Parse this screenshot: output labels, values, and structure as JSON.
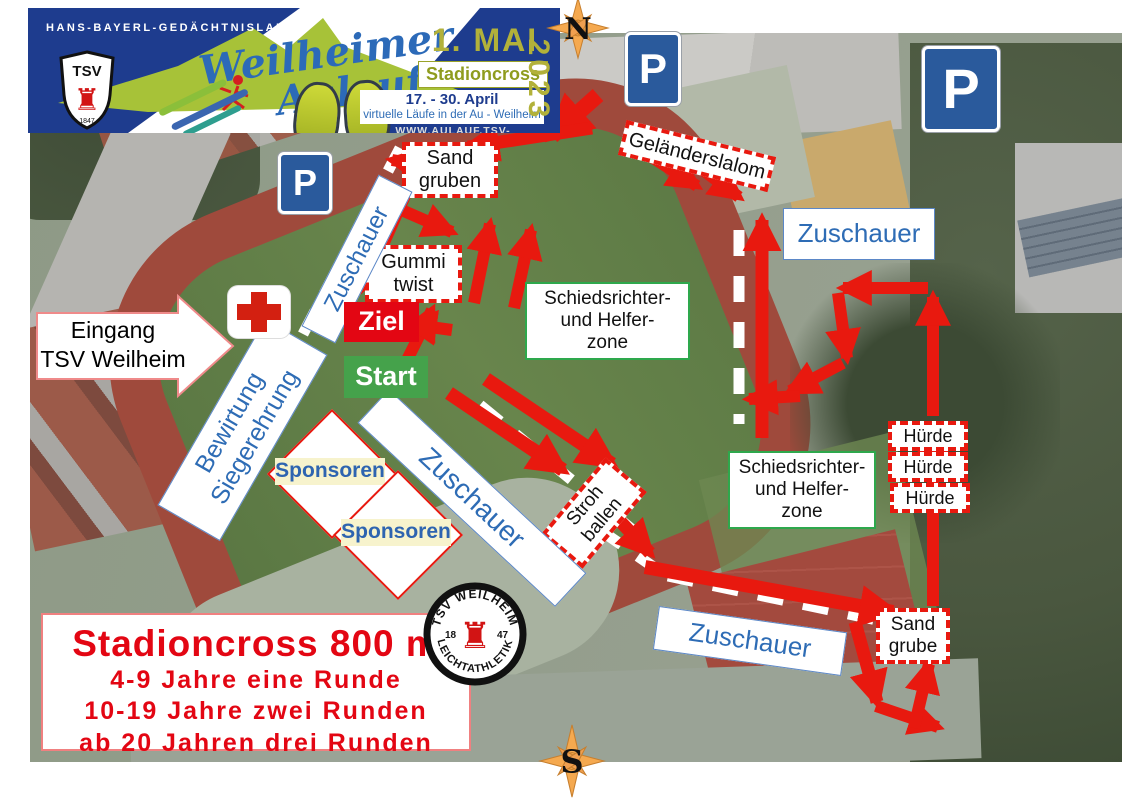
{
  "banner": {
    "kicker": "HANS-BAYERL-GEDÄCHTNISLAUF",
    "title_line1": "Weilheimer",
    "title_line2": "Aulauf",
    "date_main": "1. MAI",
    "event_name": "Stadioncross",
    "year": "2023",
    "date_range": "17. - 30. April",
    "date_sub": "virtuelle Läufe in der Au - Weilheim",
    "website": "WWW.AULAUF.TSV-WEILHEIM.COM",
    "shield_text": "TSV",
    "shield_year": "1847"
  },
  "compass": {
    "north": "N",
    "south": "S"
  },
  "entrance": {
    "line1": "Eingang",
    "line2": "TSV Weilheim"
  },
  "infobox": {
    "title": "Stadioncross 800 m",
    "rules": [
      "4-9 Jahre eine Runde",
      "10-19 Jahre zwei Runden",
      "ab 20 Jahren drei Runden"
    ]
  },
  "badge": {
    "arc_top": "TSV WEILHEIM",
    "arc_bottom": "LEICHTATHLETIK",
    "left": "18",
    "right": "47"
  },
  "colors": {
    "arrow_red": "#e8190f",
    "ziel_red": "#e30613",
    "start_green": "#45a24b",
    "label_blue": "#2e6cb5",
    "zone_green": "#2ea84c",
    "banner_navy": "#1e3c8e",
    "olive": "#b2b13a",
    "parking_blue": "#2a5a9c"
  },
  "map_labels": [
    {
      "id": "parking-sign-north-left",
      "type": "parking",
      "lines": [
        "P"
      ],
      "x": 625,
      "y": 32,
      "w": 56,
      "h": 74,
      "fs": 42
    },
    {
      "id": "parking-sign-north-right",
      "type": "parking",
      "lines": [
        "P"
      ],
      "x": 922,
      "y": 46,
      "w": 78,
      "h": 86,
      "fs": 56
    },
    {
      "id": "parking-sign-west",
      "type": "parking",
      "lines": [
        "P"
      ],
      "x": 278,
      "y": 152,
      "w": 54,
      "h": 62,
      "fs": 36
    },
    {
      "id": "label-gelaenderslalom",
      "type": "obstacle",
      "lines": [
        "Geländerslalom"
      ],
      "x": 620,
      "y": 138,
      "w": 154,
      "h": 36,
      "rot": 14,
      "fs": 20
    },
    {
      "id": "label-sandgruben",
      "type": "obstacle",
      "lines": [
        "Sand",
        "gruben"
      ],
      "x": 402,
      "y": 142,
      "w": 96,
      "h": 56,
      "rot": 0,
      "fs": 20
    },
    {
      "id": "label-gummitwist",
      "type": "obstacle",
      "lines": [
        "Gummi",
        "twist"
      ],
      "x": 365,
      "y": 245,
      "w": 97,
      "h": 58,
      "rot": 0,
      "fs": 20
    },
    {
      "id": "label-strohballen",
      "type": "obstacle",
      "lines": [
        "Stroh",
        "ballen"
      ],
      "x": 544,
      "y": 486,
      "w": 100,
      "h": 54,
      "rot": -50,
      "fs": 19
    },
    {
      "id": "label-huerde-1",
      "type": "obstacle",
      "lines": [
        "Hürde"
      ],
      "x": 888,
      "y": 421,
      "w": 80,
      "h": 30,
      "rot": 0,
      "fs": 18
    },
    {
      "id": "label-huerde-2",
      "type": "obstacle",
      "lines": [
        "Hürde"
      ],
      "x": 888,
      "y": 452,
      "w": 80,
      "h": 30,
      "rot": 0,
      "fs": 18
    },
    {
      "id": "label-huerde-3",
      "type": "obstacle",
      "lines": [
        "Hürde"
      ],
      "x": 890,
      "y": 483,
      "w": 80,
      "h": 30,
      "rot": 0,
      "fs": 18
    },
    {
      "id": "label-sandgrube",
      "type": "obstacle",
      "lines": [
        "Sand",
        "grube"
      ],
      "x": 876,
      "y": 608,
      "w": 74,
      "h": 56,
      "rot": 0,
      "fs": 19
    },
    {
      "id": "label-zuschauer-west",
      "type": "spectator",
      "lines": [
        "Zuschauer"
      ],
      "x": 272,
      "y": 240,
      "w": 170,
      "h": 38,
      "rot": -63,
      "fs": 24
    },
    {
      "id": "label-zuschauer-east",
      "type": "spectator",
      "lines": [
        "Zuschauer"
      ],
      "x": 783,
      "y": 208,
      "w": 152,
      "h": 52,
      "rot": 0,
      "fs": 26
    },
    {
      "id": "label-zuschauer-center",
      "type": "spectator",
      "lines": [
        "Zuschauer"
      ],
      "x": 337,
      "y": 475,
      "w": 270,
      "h": 46,
      "rot": 43,
      "fs": 28
    },
    {
      "id": "label-zuschauer-south",
      "type": "spectator",
      "lines": [
        "Zuschauer"
      ],
      "x": 655,
      "y": 619,
      "w": 190,
      "h": 44,
      "rot": 8,
      "fs": 26
    },
    {
      "id": "label-bewirtung-siegerehrung",
      "type": "spectator",
      "lines": [
        "Bewirtung",
        "Siegerehrung"
      ],
      "x": 135,
      "y": 394,
      "w": 215,
      "h": 72,
      "rot": -60,
      "fs": 25
    },
    {
      "id": "label-schiedsrichterzone-1",
      "type": "zone",
      "lines": [
        "Schiedsrichter-",
        "und Helfer-",
        "zone"
      ],
      "x": 525,
      "y": 282,
      "w": 165,
      "h": 78,
      "rot": 0,
      "fs": 19
    },
    {
      "id": "label-schiedsrichterzone-2",
      "type": "zone",
      "lines": [
        "Schiedsrichter-",
        "und Helfer-",
        "zone"
      ],
      "x": 728,
      "y": 451,
      "w": 148,
      "h": 78,
      "rot": 0,
      "fs": 19
    },
    {
      "id": "label-ziel",
      "type": "ziel",
      "lines": [
        "Ziel"
      ],
      "x": 344,
      "y": 302,
      "w": 75,
      "h": 40,
      "rot": 0,
      "fs": 27
    },
    {
      "id": "label-start",
      "type": "start",
      "lines": [
        "Start"
      ],
      "x": 344,
      "y": 356,
      "w": 84,
      "h": 42,
      "rot": 0,
      "fs": 27
    },
    {
      "id": "label-sponsoren-1",
      "type": "sponsor",
      "lines": [
        "Sponsoren"
      ],
      "x": 275,
      "y": 458,
      "w": 110,
      "h": 27,
      "rot": 0,
      "fs": 21,
      "diamond": 88
    },
    {
      "id": "label-sponsoren-2",
      "type": "sponsor",
      "lines": [
        "Sponsoren"
      ],
      "x": 341,
      "y": 519,
      "w": 110,
      "h": 27,
      "rot": 0,
      "fs": 21,
      "diamond": 88
    }
  ],
  "course": {
    "arrows": [
      [
        598,
        95,
        552,
        136,
        16
      ],
      [
        592,
        128,
        468,
        147,
        13
      ],
      [
        452,
        170,
        392,
        160,
        12
      ],
      [
        390,
        205,
        452,
        232,
        12
      ],
      [
        416,
        170,
        363,
        288,
        13
      ],
      [
        452,
        330,
        408,
        324,
        12
      ],
      [
        403,
        368,
        432,
        310,
        12
      ],
      [
        474,
        303,
        490,
        224,
        12
      ],
      [
        514,
        308,
        531,
        230,
        12
      ],
      [
        449,
        393,
        563,
        470,
        14
      ],
      [
        486,
        379,
        612,
        464,
        14
      ],
      [
        604,
        504,
        650,
        553,
        13
      ],
      [
        645,
        567,
        893,
        612,
        14
      ],
      [
        855,
        622,
        877,
        702,
        13
      ],
      [
        876,
        706,
        938,
        727,
        12
      ],
      [
        914,
        728,
        929,
        664,
        12
      ],
      [
        933,
        606,
        933,
        428,
        12
      ],
      [
        933,
        416,
        933,
        297,
        12
      ],
      [
        928,
        288,
        843,
        288,
        12
      ],
      [
        838,
        293,
        847,
        358,
        12
      ],
      [
        843,
        363,
        790,
        391,
        12
      ],
      [
        800,
        396,
        749,
        399,
        12
      ],
      [
        762,
        438,
        762,
        220,
        13
      ],
      [
        636,
        147,
        697,
        186,
        12
      ],
      [
        664,
        141,
        739,
        197,
        12
      ]
    ],
    "barriers": [
      [
        400,
        148,
        303,
        334
      ],
      [
        480,
        405,
        640,
        536
      ],
      [
        600,
        530,
        655,
        568
      ],
      [
        668,
        576,
        925,
        630
      ],
      [
        739,
        230,
        739,
        424
      ]
    ]
  }
}
